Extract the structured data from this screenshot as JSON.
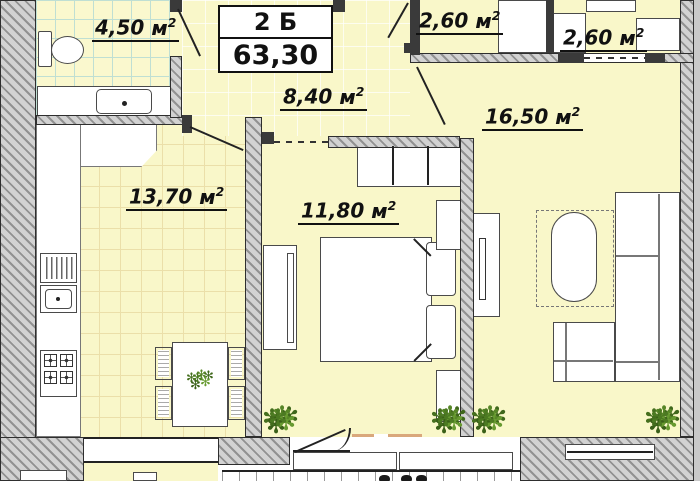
{
  "plan": {
    "title_block": {
      "type_label": "2 Б",
      "total_area": "63,30"
    },
    "unit": {
      "base": "м",
      "sup": "2"
    },
    "rooms": {
      "bathroom": {
        "area": "4,50"
      },
      "hallway": {
        "area": "8,40"
      },
      "kitchen": {
        "area": "13,70"
      },
      "bedroom": {
        "area": "11,80"
      },
      "living_room": {
        "area": "16,50"
      },
      "balcony_left": {
        "area": "2,60"
      },
      "balcony_right": {
        "area": "2,60"
      }
    },
    "icons": {
      "plant": "✻"
    },
    "colors": {
      "floor": "#F9F7C9",
      "bathroom_grid": "#BFDFD3",
      "kitchen_grid": "#EBDFA9",
      "wall_fill": "#D2D2D2",
      "wall_line": "#2E2E2E",
      "window_sill": "#D9A87C",
      "plant_green": "#4C7A22"
    }
  }
}
